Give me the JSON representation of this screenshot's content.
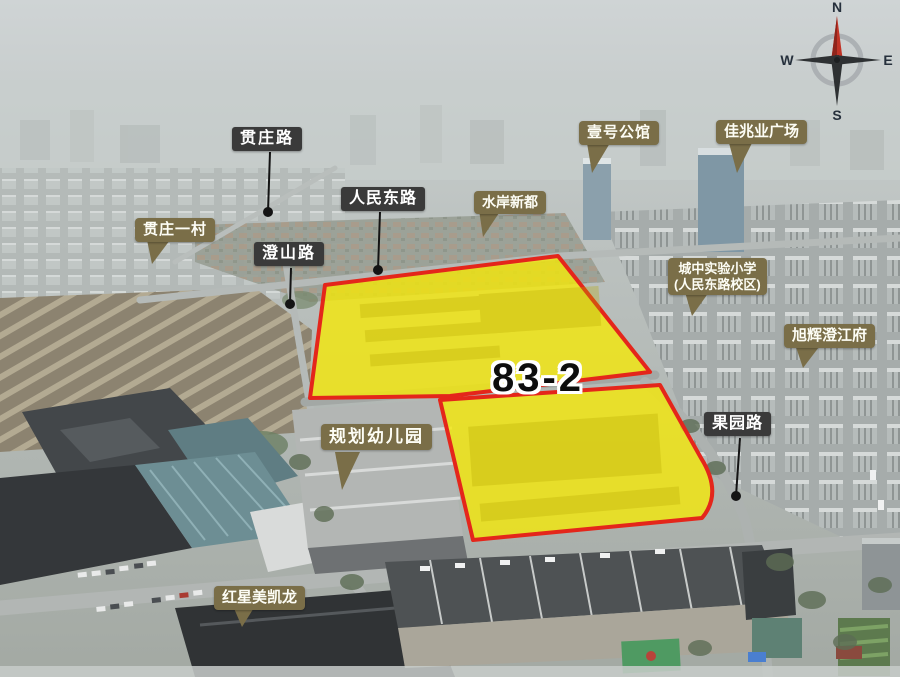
{
  "parcel": {
    "id": "83-2",
    "fill_color": "#f5e909",
    "border_color": "#e4261b"
  },
  "labels": {
    "roads": [
      {
        "text": "贯庄路"
      },
      {
        "text": "人民东路"
      },
      {
        "text": "澄山路"
      },
      {
        "text": "果园路"
      }
    ],
    "places": [
      {
        "text": "贯庄一村"
      },
      {
        "text": "壹号公馆"
      },
      {
        "text": "佳兆业广场"
      },
      {
        "text": "水岸新都"
      },
      {
        "line1": "城中实验小学",
        "line2": "(人民东路校区)"
      },
      {
        "text": "旭辉澄江府"
      },
      {
        "text": "规划幼儿园"
      },
      {
        "text": "红星美凯龙"
      }
    ]
  },
  "compass": {
    "n": "N",
    "e": "E",
    "s": "S",
    "w": "W"
  },
  "colors": {
    "road_label_bg": "#3a3a3a",
    "place_label_bg": "#7a6e48",
    "label_text": "#ffffff",
    "compass_north_needle": "#c13326"
  }
}
